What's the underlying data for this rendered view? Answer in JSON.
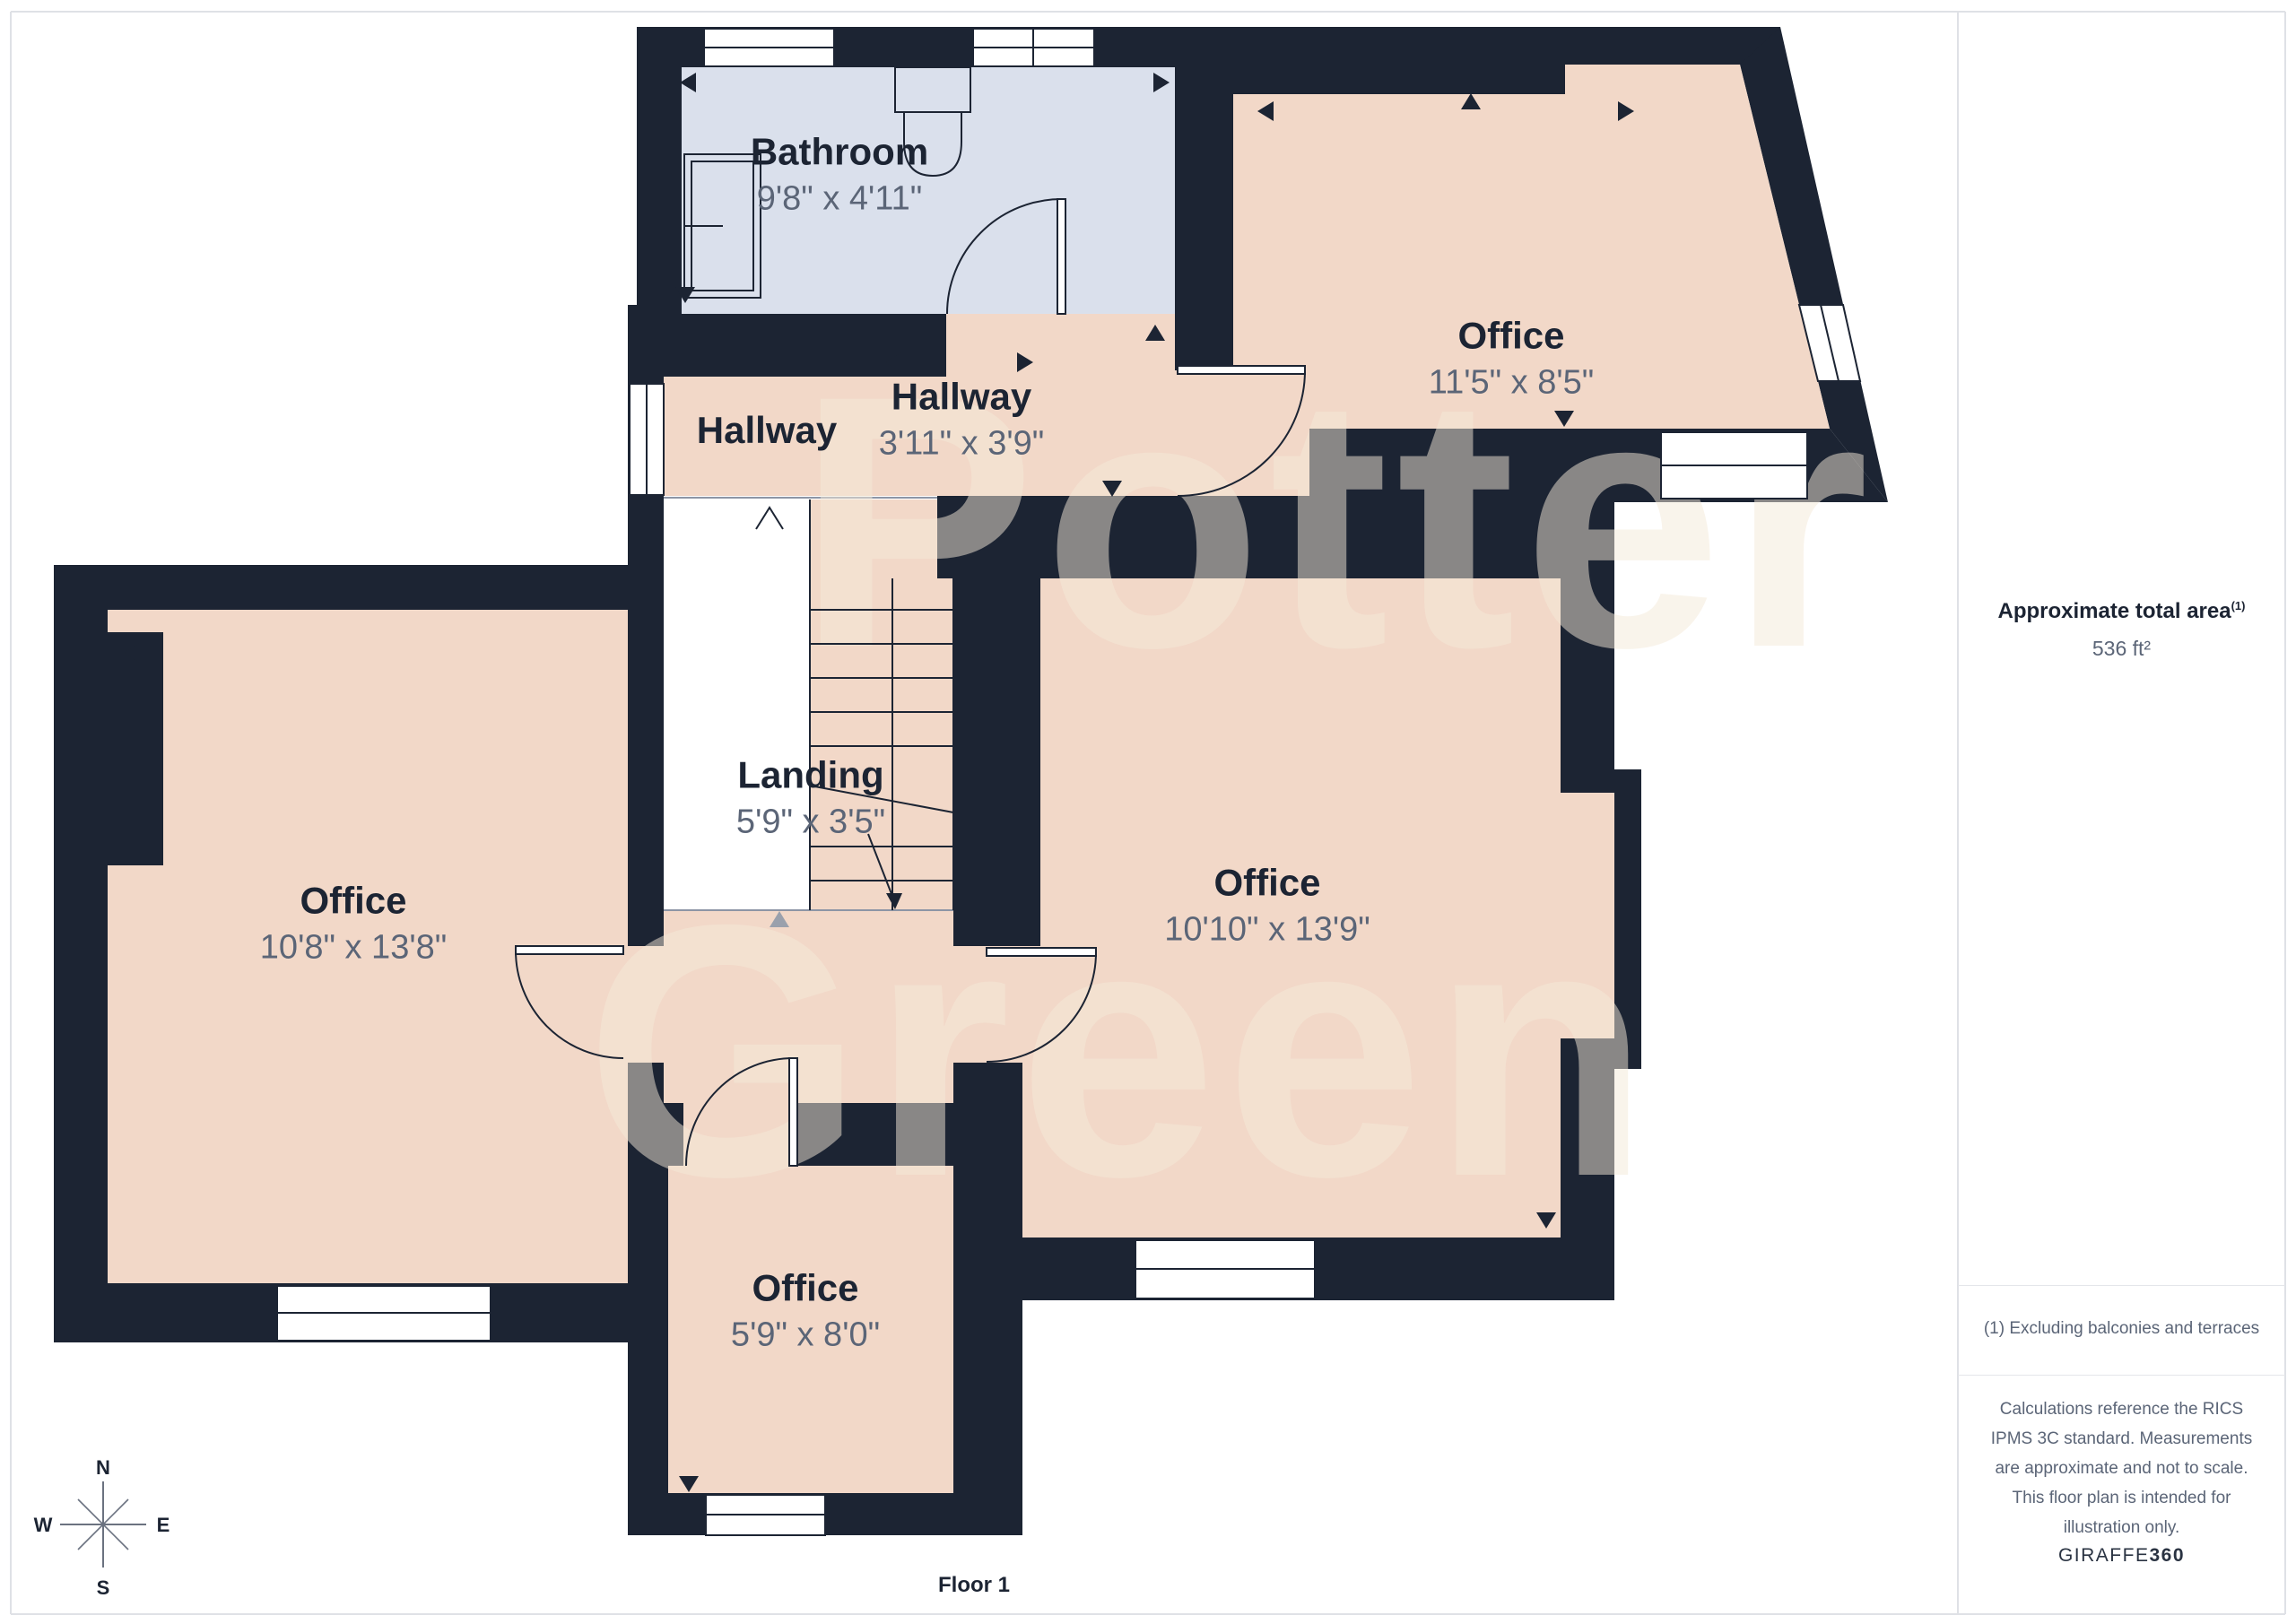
{
  "watermark": {
    "line1": "Potter",
    "line2": "Green"
  },
  "rooms": [
    {
      "name": "Bathroom",
      "dims": "9'8\" x 4'11\""
    },
    {
      "name": "Hallway",
      "dims": ""
    },
    {
      "name": "Hallway",
      "dims": "3'11\" x 3'9\""
    },
    {
      "name": "Office",
      "dims": "11'5\" x 8'5\""
    },
    {
      "name": "Landing",
      "dims": "5'9\" x 3'5\""
    },
    {
      "name": "Office",
      "dims": "10'8\" x 13'8\""
    },
    {
      "name": "Office",
      "dims": "10'10\" x 13'9\""
    },
    {
      "name": "Office",
      "dims": "5'9\" x 8'0\""
    }
  ],
  "sidebar": {
    "area_title": "Approximate total area",
    "area_superscript": "(1)",
    "area_value": "536 ft²",
    "footnote": "(1) Excluding balconies and terraces",
    "disclaimer": "Calculations reference the RICS IPMS 3C standard. Measurements are approximate and not to scale. This floor plan is intended for illustration only.",
    "brand": "GIRAFFE",
    "brand_suffix": "360"
  },
  "compass": {
    "north": "N",
    "south": "S",
    "east": "E",
    "west": "W"
  },
  "floor_label": "Floor 1",
  "colors": {
    "wall": "#1c2433",
    "room_fill": "#f2d8c8",
    "bathroom_fill": "#dae0ec",
    "landing_fill": "#ffffff",
    "label_text": "#1c2433",
    "dims_text": "#5b6577",
    "watermark": "#f5ead9"
  }
}
